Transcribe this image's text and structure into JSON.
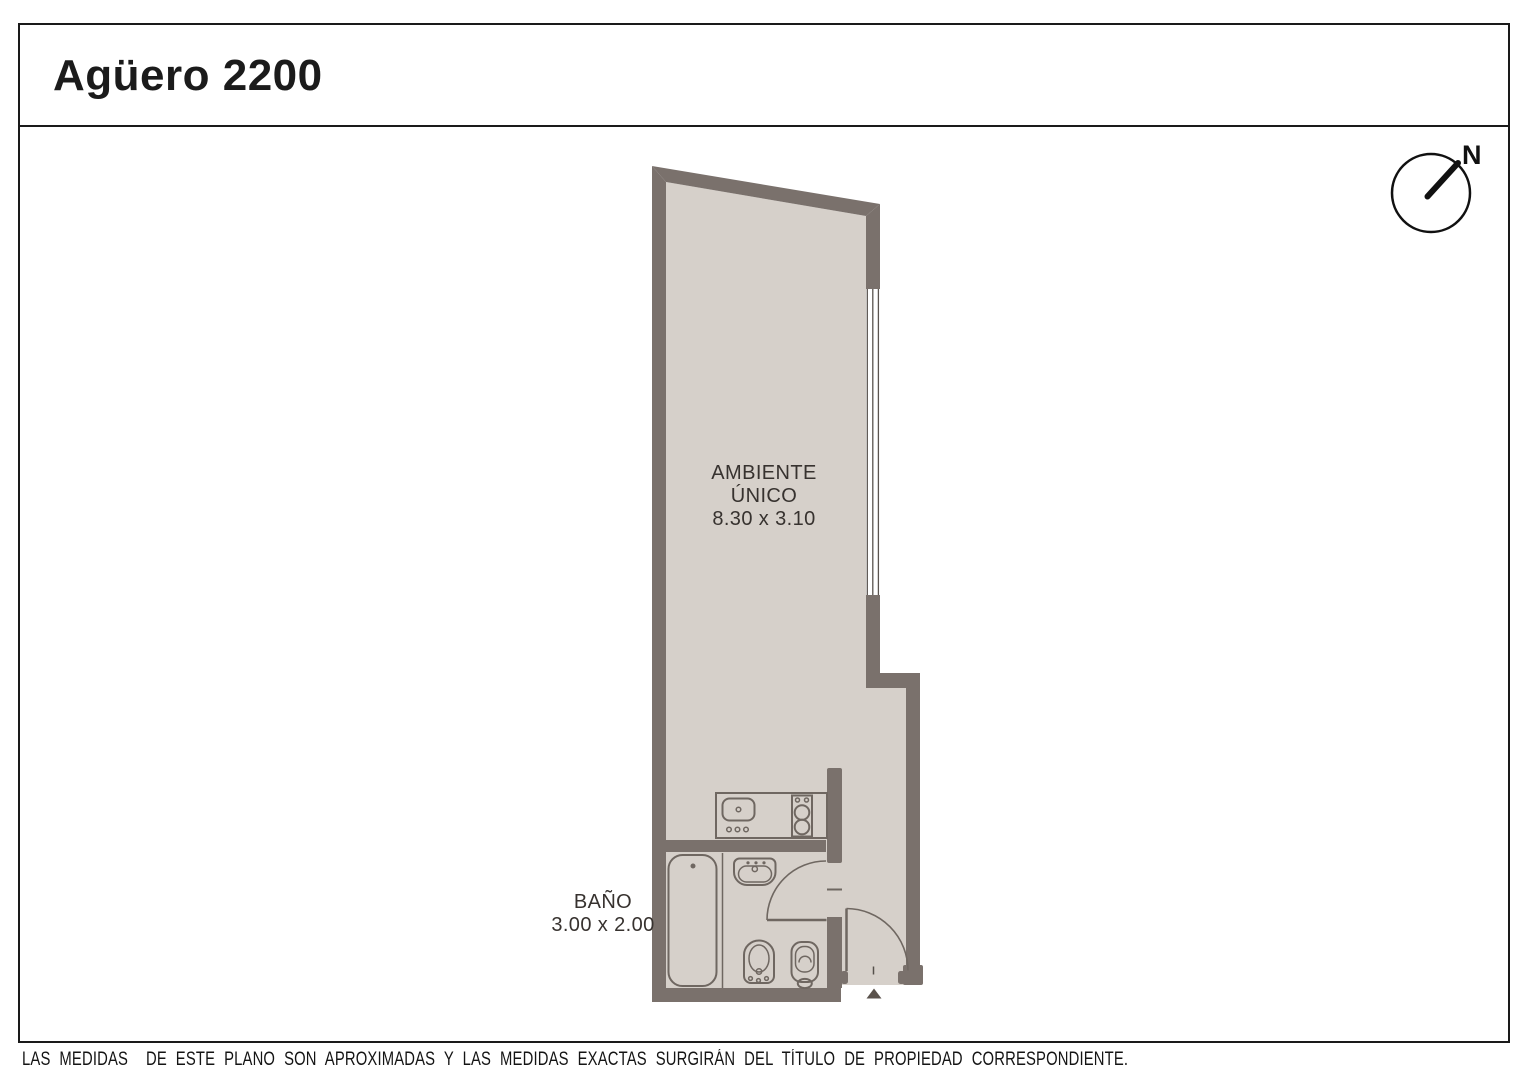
{
  "title": "Agüero 2200",
  "compass": {
    "north_label": "N"
  },
  "rooms": {
    "main": {
      "name_line1": "AMBIENTE",
      "name_line2": "ÚNICO",
      "dimensions": "8.30 x 3.10"
    },
    "bathroom": {
      "name_line1": "BAÑO",
      "dimensions": "3.00 x 2.00"
    }
  },
  "fixtures": [
    "compass-icon",
    "window",
    "kitchen-counter",
    "kitchen-sink-icon",
    "cooktop-icon",
    "bathtub-icon",
    "washbasin-icon",
    "bidet-icon",
    "toilet-icon",
    "bathroom-door-swing",
    "entry-door-swing",
    "entry-arrow-icon"
  ],
  "footer": {
    "disclaimer": "LAS MEDIDAS  DE ESTE PLANO SON APROXIMADAS Y LAS MEDIDAS EXACTAS SURGIRÁN DEL TÍTULO DE PROPIEDAD CORRESPONDIENTE.",
    "credit": "CONFECCIONADO POR ESTUDIO NARTEX"
  },
  "theme": {
    "wall_color": "#7a716c",
    "floor_color": "#d6d0ca",
    "line_color": "#6f6761",
    "frame_color": "#1a1a1a",
    "text_color": "#37322f",
    "page_bg": "#ffffff"
  }
}
